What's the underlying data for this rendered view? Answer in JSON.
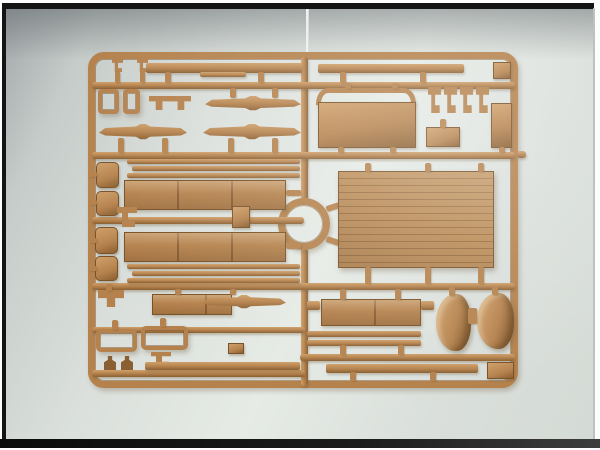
{
  "scene": {
    "kind": "photograph",
    "subject": "injection-molded plastic model kit sprue (parts tree) in tan plastic, photographed on a pale grey backdrop with black border bars",
    "visible_text": "none"
  },
  "palette": {
    "plastic_main": "#b5824d",
    "plastic_hi": "#cfa06a",
    "plastic_lo": "#8a5f31",
    "plastic_edge": "#7a5228",
    "plank_base": "#b98a55",
    "bg_hi": "#e6ebe6",
    "bg_mid": "#dadfdb",
    "bg_lo": "#c6ccc9",
    "bg_lo2": "#d4dad5",
    "bg_shadow": "#a2a8aa",
    "frame_black": "#141414",
    "edge_gray": "#bcc2bf"
  },
  "sprue": {
    "parts": [
      {
        "id": "sprue-outer-frame",
        "type": "frame",
        "x": 88,
        "y": 52,
        "w": 430,
        "h": 336,
        "bw": 7,
        "r": 16
      },
      {
        "id": "runner-vertical-top",
        "type": "runner-v",
        "x": 301,
        "y": 57,
        "w": 7,
        "h": 143
      },
      {
        "id": "runner-vertical-bottom",
        "type": "runner-v",
        "x": 301,
        "y": 248,
        "w": 7,
        "h": 138
      },
      {
        "id": "runner-ring",
        "type": "frame",
        "x": 278,
        "y": 198,
        "w": 52,
        "h": 52,
        "bw": 7,
        "r": 26
      },
      {
        "id": "ring-arm-top",
        "type": "lug",
        "x": 326,
        "y": 204,
        "w": 14,
        "h": 6,
        "rot": -18
      },
      {
        "id": "ring-arm-bottom",
        "type": "lug",
        "x": 326,
        "y": 238,
        "w": 14,
        "h": 6,
        "rot": 18
      },
      {
        "id": "runner-horizontal-1",
        "type": "runner-h",
        "x": 92,
        "y": 82,
        "w": 423,
        "h": 7
      },
      {
        "id": "runner-horizontal-2",
        "type": "runner-h",
        "x": 92,
        "y": 152,
        "w": 423,
        "h": 7
      },
      {
        "id": "runner-horizontal-3-left",
        "type": "runner-h",
        "x": 92,
        "y": 217,
        "w": 212,
        "h": 7
      },
      {
        "id": "runner-horizontal-4",
        "type": "runner-h",
        "x": 92,
        "y": 283,
        "w": 423,
        "h": 7
      },
      {
        "id": "runner-horizontal-5-left",
        "type": "runner-h",
        "x": 92,
        "y": 327,
        "w": 213,
        "h": 6
      },
      {
        "id": "runner-horizontal-5-right",
        "type": "runner-h",
        "x": 300,
        "y": 354,
        "w": 215,
        "h": 7
      },
      {
        "id": "runner-horizontal-6-left",
        "type": "runner-h",
        "x": 92,
        "y": 370,
        "w": 213,
        "h": 7
      },
      {
        "id": "frame-outer-stub-right",
        "type": "runner-h",
        "x": 517,
        "y": 151,
        "w": 9,
        "h": 7
      },
      {
        "id": "tiny-clip-1",
        "type": "clip",
        "x": 112,
        "y": 59,
        "w": 11,
        "h": 13
      },
      {
        "id": "tiny-clip-2",
        "type": "clip",
        "x": 137,
        "y": 59,
        "w": 11,
        "h": 13
      },
      {
        "id": "lug-clip1",
        "type": "lug",
        "x": 115,
        "y": 71,
        "w": 5,
        "h": 12
      },
      {
        "id": "lug-clip2",
        "type": "lug",
        "x": 140,
        "y": 71,
        "w": 5,
        "h": 12
      },
      {
        "id": "long-strip-left",
        "type": "strip",
        "x": 146,
        "y": 63,
        "w": 156,
        "h": 10
      },
      {
        "id": "long-strip-left-step",
        "type": "strip",
        "x": 200,
        "y": 72,
        "w": 46,
        "h": 5
      },
      {
        "id": "long-strip-right",
        "type": "strip",
        "x": 318,
        "y": 64,
        "w": 146,
        "h": 9
      },
      {
        "id": "small-plate-topright",
        "type": "box",
        "x": 493,
        "y": 62,
        "w": 18,
        "h": 17
      },
      {
        "id": "lug-strip1-a",
        "type": "lug",
        "x": 165,
        "y": 72,
        "w": 6,
        "h": 11
      },
      {
        "id": "lug-strip1-b",
        "type": "lug",
        "x": 258,
        "y": 72,
        "w": 6,
        "h": 11
      },
      {
        "id": "lug-strip2-a",
        "type": "lug",
        "x": 340,
        "y": 72,
        "w": 6,
        "h": 11
      },
      {
        "id": "lug-strip2-b",
        "type": "lug",
        "x": 420,
        "y": 72,
        "w": 6,
        "h": 11
      },
      {
        "id": "window-frame-small-1",
        "type": "frame",
        "x": 98,
        "y": 89,
        "w": 21,
        "h": 25,
        "bw": 4,
        "r": 4
      },
      {
        "id": "window-frame-small-2",
        "type": "frame",
        "x": 123,
        "y": 89,
        "w": 17,
        "h": 25,
        "bw": 4,
        "r": 4
      },
      {
        "id": "bench-bracket",
        "type": "bench",
        "x": 149,
        "y": 96,
        "w": 42,
        "h": 14
      },
      {
        "id": "leaf-spring-1",
        "type": "spring",
        "x": 205,
        "y": 96,
        "w": 96,
        "h": 15
      },
      {
        "id": "leaf-spring-2",
        "type": "spring",
        "x": 99,
        "y": 124,
        "w": 88,
        "h": 16
      },
      {
        "id": "leaf-spring-3",
        "type": "spring",
        "x": 203,
        "y": 124,
        "w": 98,
        "h": 16
      },
      {
        "id": "lug-spring1-a",
        "type": "lug",
        "x": 230,
        "y": 88,
        "w": 6,
        "h": 10
      },
      {
        "id": "lug-spring1-b",
        "type": "lug",
        "x": 272,
        "y": 88,
        "w": 6,
        "h": 10
      },
      {
        "id": "lug-spring2-a",
        "type": "lug",
        "x": 118,
        "y": 138,
        "w": 6,
        "h": 15
      },
      {
        "id": "lug-spring2-b",
        "type": "lug",
        "x": 162,
        "y": 138,
        "w": 6,
        "h": 15
      },
      {
        "id": "lug-spring3-a",
        "type": "lug",
        "x": 228,
        "y": 138,
        "w": 6,
        "h": 15
      },
      {
        "id": "lug-spring3-b",
        "type": "lug",
        "x": 272,
        "y": 138,
        "w": 6,
        "h": 15
      },
      {
        "id": "arch-rail",
        "type": "arch",
        "x": 316,
        "y": 88,
        "w": 100,
        "h": 17
      },
      {
        "id": "front-board",
        "type": "panel",
        "x": 318,
        "y": 102,
        "w": 98,
        "h": 46
      },
      {
        "id": "lug-arch-a",
        "type": "lug",
        "x": 345,
        "y": 83,
        "w": 6,
        "h": 6
      },
      {
        "id": "lug-arch-b",
        "type": "lug",
        "x": 392,
        "y": 83,
        "w": 6,
        "h": 6
      },
      {
        "id": "lug-frontboard-a",
        "type": "lug",
        "x": 338,
        "y": 147,
        "w": 6,
        "h": 6
      },
      {
        "id": "lug-frontboard-b",
        "type": "lug",
        "x": 390,
        "y": 147,
        "w": 6,
        "h": 6
      },
      {
        "id": "hook-clip-1",
        "type": "clip",
        "x": 428,
        "y": 87,
        "w": 13,
        "h": 26
      },
      {
        "id": "hook-clip-2",
        "type": "clip",
        "x": 444,
        "y": 87,
        "w": 13,
        "h": 26
      },
      {
        "id": "hook-clip-3",
        "type": "clip",
        "x": 460,
        "y": 87,
        "w": 13,
        "h": 26
      },
      {
        "id": "hook-clip-4",
        "type": "clip",
        "x": 476,
        "y": 87,
        "w": 13,
        "h": 26
      },
      {
        "id": "small-box-mid",
        "type": "box",
        "x": 426,
        "y": 127,
        "w": 34,
        "h": 20
      },
      {
        "id": "lug-boxmid",
        "type": "lug",
        "x": 440,
        "y": 119,
        "w": 6,
        "h": 9
      },
      {
        "id": "tall-plate-right",
        "type": "panel",
        "x": 491,
        "y": 103,
        "w": 21,
        "h": 45
      },
      {
        "id": "lug-tallplate",
        "type": "lug",
        "x": 499,
        "y": 147,
        "w": 6,
        "h": 6
      },
      {
        "id": "pad-1",
        "type": "pad",
        "x": 96,
        "y": 162,
        "w": 23,
        "h": 26
      },
      {
        "id": "pad-2",
        "type": "pad",
        "x": 96,
        "y": 191,
        "w": 23,
        "h": 25
      },
      {
        "id": "pad-3",
        "type": "pad",
        "x": 95,
        "y": 227,
        "w": 23,
        "h": 27
      },
      {
        "id": "pad-4",
        "type": "pad",
        "x": 95,
        "y": 256,
        "w": 23,
        "h": 25
      },
      {
        "id": "lug-pad-1",
        "type": "lug",
        "x": 89,
        "y": 172,
        "w": 8,
        "h": 5
      },
      {
        "id": "lug-pad-2",
        "type": "lug",
        "x": 89,
        "y": 200,
        "w": 8,
        "h": 5
      },
      {
        "id": "lug-pad-3",
        "type": "lug",
        "x": 89,
        "y": 238,
        "w": 8,
        "h": 5
      },
      {
        "id": "lug-pad-4",
        "type": "lug",
        "x": 89,
        "y": 266,
        "w": 8,
        "h": 5
      },
      {
        "id": "t-shaped-part",
        "type": "tpart",
        "x": 98,
        "y": 290,
        "w": 26,
        "h": 17
      },
      {
        "id": "lug-tpart",
        "type": "lug",
        "x": 106,
        "y": 284,
        "w": 6,
        "h": 7
      },
      {
        "id": "thin-strip-1a",
        "type": "strip",
        "x": 127,
        "y": 159,
        "w": 173,
        "h": 5
      },
      {
        "id": "thin-strip-1b",
        "type": "strip",
        "x": 132,
        "y": 166,
        "w": 168,
        "h": 5
      },
      {
        "id": "thin-strip-1c",
        "type": "strip",
        "x": 127,
        "y": 173,
        "w": 173,
        "h": 5
      },
      {
        "id": "side-board-upper",
        "type": "board",
        "x": 124,
        "y": 180,
        "w": 162,
        "h": 30
      },
      {
        "id": "coupler-part",
        "type": "box",
        "x": 232,
        "y": 206,
        "w": 18,
        "h": 22
      },
      {
        "id": "left-hook-part",
        "type": "clip",
        "x": 117,
        "y": 207,
        "w": 20,
        "h": 20
      },
      {
        "id": "side-board-lower",
        "type": "board",
        "x": 124,
        "y": 232,
        "w": 162,
        "h": 30
      },
      {
        "id": "thin-strip-2a",
        "type": "strip",
        "x": 127,
        "y": 264,
        "w": 173,
        "h": 5
      },
      {
        "id": "thin-strip-2b",
        "type": "strip",
        "x": 132,
        "y": 271,
        "w": 168,
        "h": 5
      },
      {
        "id": "thin-strip-2c",
        "type": "strip",
        "x": 127,
        "y": 278,
        "w": 173,
        "h": 5
      },
      {
        "id": "lug-board-right-a",
        "type": "lug",
        "x": 286,
        "y": 190,
        "w": 15,
        "h": 6
      },
      {
        "id": "lug-board-right-b",
        "type": "lug",
        "x": 286,
        "y": 243,
        "w": 15,
        "h": 6
      },
      {
        "id": "cargo-floor-panel",
        "type": "planked",
        "x": 338,
        "y": 171,
        "w": 156,
        "h": 97
      },
      {
        "id": "lug-floor-top-a",
        "type": "lug",
        "x": 365,
        "y": 163,
        "w": 6,
        "h": 9
      },
      {
        "id": "lug-floor-top-b",
        "type": "lug",
        "x": 425,
        "y": 163,
        "w": 6,
        "h": 9
      },
      {
        "id": "lug-floor-top-c",
        "type": "lug",
        "x": 478,
        "y": 163,
        "w": 6,
        "h": 9
      },
      {
        "id": "lug-floor-bottom-a",
        "type": "lug",
        "x": 365,
        "y": 267,
        "w": 6,
        "h": 17
      },
      {
        "id": "lug-floor-bottom-b",
        "type": "lug",
        "x": 425,
        "y": 267,
        "w": 6,
        "h": 17
      },
      {
        "id": "lug-floor-bottom-c",
        "type": "lug",
        "x": 478,
        "y": 267,
        "w": 6,
        "h": 17
      },
      {
        "id": "small-board",
        "type": "board",
        "x": 152,
        "y": 294,
        "w": 80,
        "h": 21
      },
      {
        "id": "leaf-spring-4",
        "type": "spring",
        "x": 202,
        "y": 295,
        "w": 84,
        "h": 14
      },
      {
        "id": "lug-smallboard-a",
        "type": "lug",
        "x": 175,
        "y": 289,
        "w": 6,
        "h": 6
      },
      {
        "id": "lug-smallboard-b",
        "type": "lug",
        "x": 230,
        "y": 289,
        "w": 6,
        "h": 6
      },
      {
        "id": "windshield-frame-1",
        "type": "frame",
        "x": 96,
        "y": 329,
        "w": 41,
        "h": 23,
        "bw": 4,
        "r": 5
      },
      {
        "id": "windshield-frame-2",
        "type": "frame",
        "x": 141,
        "y": 326,
        "w": 47,
        "h": 24,
        "bw": 4,
        "r": 5
      },
      {
        "id": "lug-wframe-1",
        "type": "lug",
        "x": 112,
        "y": 320,
        "w": 6,
        "h": 10
      },
      {
        "id": "lug-wframe-2",
        "type": "lug",
        "x": 160,
        "y": 318,
        "w": 6,
        "h": 9
      },
      {
        "id": "angle-bracket",
        "type": "clip",
        "x": 151,
        "y": 352,
        "w": 20,
        "h": 14
      },
      {
        "id": "small-bracket-l",
        "type": "box",
        "x": 228,
        "y": 343,
        "w": 16,
        "h": 11
      },
      {
        "id": "figure-1",
        "type": "figure",
        "x": 104,
        "y": 356,
        "w": 12,
        "h": 14
      },
      {
        "id": "figure-2",
        "type": "figure",
        "x": 121,
        "y": 356,
        "w": 12,
        "h": 14
      },
      {
        "id": "notched-strip-bottom",
        "type": "strip",
        "x": 145,
        "y": 362,
        "w": 155,
        "h": 8
      },
      {
        "id": "tailgate-board",
        "type": "board",
        "x": 321,
        "y": 299,
        "w": 100,
        "h": 27
      },
      {
        "id": "wing-strip-left",
        "type": "strip",
        "x": 307,
        "y": 301,
        "w": 13,
        "h": 9
      },
      {
        "id": "wing-strip-right",
        "type": "strip",
        "x": 421,
        "y": 301,
        "w": 13,
        "h": 9
      },
      {
        "id": "lug-tailgate-a",
        "type": "lug",
        "x": 340,
        "y": 289,
        "w": 6,
        "h": 11
      },
      {
        "id": "lug-tailgate-b",
        "type": "lug",
        "x": 395,
        "y": 289,
        "w": 6,
        "h": 11
      },
      {
        "id": "thin-strip-3a",
        "type": "strip",
        "x": 307,
        "y": 331,
        "w": 114,
        "h": 6
      },
      {
        "id": "thin-strip-3b",
        "type": "strip",
        "x": 307,
        "y": 340,
        "w": 114,
        "h": 6
      },
      {
        "id": "lug-strip3-a",
        "type": "lug",
        "x": 340,
        "y": 345,
        "w": 6,
        "h": 10
      },
      {
        "id": "lug-strip3-b",
        "type": "lug",
        "x": 398,
        "y": 345,
        "w": 6,
        "h": 10
      },
      {
        "id": "fender-1",
        "type": "fender",
        "x": 436,
        "y": 294,
        "w": 35,
        "h": 57
      },
      {
        "id": "fender-2",
        "type": "fender",
        "x": 477,
        "y": 293,
        "w": 37,
        "h": 56
      },
      {
        "id": "fender-link",
        "type": "lug",
        "x": 468,
        "y": 308,
        "w": 9,
        "h": 16
      },
      {
        "id": "lug-fender-1",
        "type": "lug",
        "x": 449,
        "y": 287,
        "w": 6,
        "h": 9
      },
      {
        "id": "lug-fender-2",
        "type": "lug",
        "x": 492,
        "y": 286,
        "w": 6,
        "h": 9
      },
      {
        "id": "small-box-bottom",
        "type": "box",
        "x": 487,
        "y": 362,
        "w": 27,
        "h": 17
      },
      {
        "id": "ladder-strip",
        "type": "strip",
        "x": 326,
        "y": 364,
        "w": 152,
        "h": 9
      },
      {
        "id": "lug-ladder-a",
        "type": "lug",
        "x": 350,
        "y": 372,
        "w": 6,
        "h": 9
      },
      {
        "id": "lug-ladder-b",
        "type": "lug",
        "x": 430,
        "y": 372,
        "w": 6,
        "h": 9
      }
    ]
  }
}
